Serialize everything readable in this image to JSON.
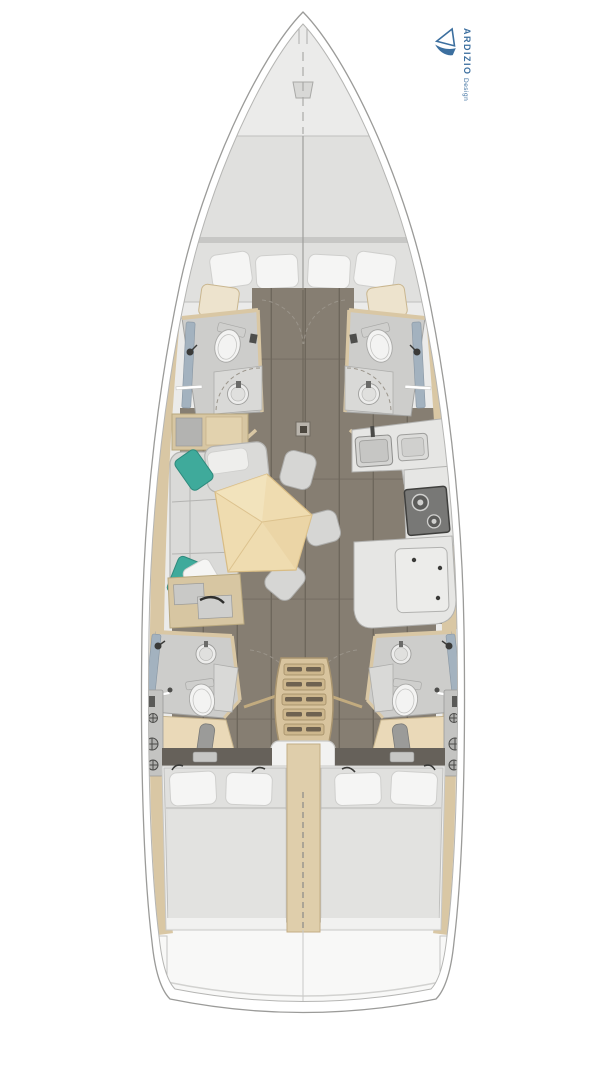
{
  "logo": {
    "brand": "ARDIZIO",
    "tagline": "Design"
  },
  "colors": {
    "white": "#ffffff",
    "logoblue": "#3c6f9f",
    "hullline": "#9b9b99",
    "deck": "#ebebea",
    "stern": "#f8f8f7",
    "floor": "#867e72",
    "plank": "#6e675c",
    "wood": "#d9c7a4",
    "wooddark": "#c2ab7f",
    "mattress": "#e0e0de",
    "matedge": "#bfbfbd",
    "pillow": "#f5f5f4",
    "pilledge": "#cfcfcd",
    "sofa": "#dadad8",
    "sofaedge": "#b4b4b2",
    "teal": "#3faa9b",
    "tealedge": "#2f8a7d",
    "table": "#efdcb0",
    "tabledge": "#d8bc84",
    "chair": "#d6d6d4",
    "chairedge": "#adadab",
    "bathfloor": "#cdcdcb",
    "bathedge": "#a3a3a1",
    "counter": "#e6e6e4",
    "counteredge": "#b2b2b0",
    "fixture": "#f3f3f2",
    "fixedge": "#a9a9a7",
    "shower": "#a3b2bf",
    "stove": "#787876",
    "stovedark": "#3f3f3d",
    "stair": "#d8c49e",
    "stairedge": "#a8946f",
    "tread": "#cdb78d",
    "stairslot": "#6e6250",
    "divider": "#dfceab",
    "panel": "#c4c4c2",
    "paneledge": "#9a9a98",
    "dark": "#3a3a38",
    "graymid": "#c9c9c7",
    "headboard": "#66615a"
  }
}
